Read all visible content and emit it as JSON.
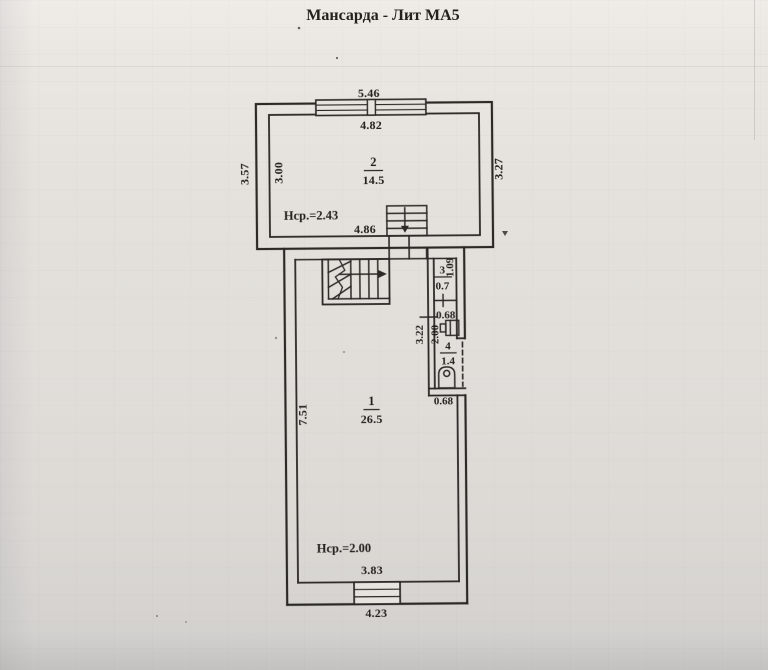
{
  "title": "Мансарда - Лит МА5",
  "floor_plan": {
    "rooms": {
      "room1": {
        "number": "1",
        "area": "26.5"
      },
      "room2": {
        "number": "2",
        "area": "14.5"
      },
      "room3": {
        "number": "3",
        "area": "0.7"
      },
      "room4": {
        "number": "4",
        "area": "1.4"
      }
    },
    "heights": {
      "room2_note": "Нср.=2.43",
      "room1_note": "Нср.=2.00"
    },
    "dimensions": {
      "top_outer": "5.46",
      "top_inner": "4.82",
      "left_outer": "3.57",
      "left_inner": "3.00",
      "right_outer": "3.27",
      "room2_bottom": "4.86",
      "room3_side": "1.09",
      "sink_width": "0.68",
      "hall_left": "3.22",
      "hall_inner": "2.00",
      "wc_bottom": "0.68",
      "room1_left": "7.51",
      "bottom_inner": "3.83",
      "bottom_outer": "4.23"
    }
  },
  "colors": {
    "ink": "#2b2926",
    "paper": "#e6e3de"
  }
}
